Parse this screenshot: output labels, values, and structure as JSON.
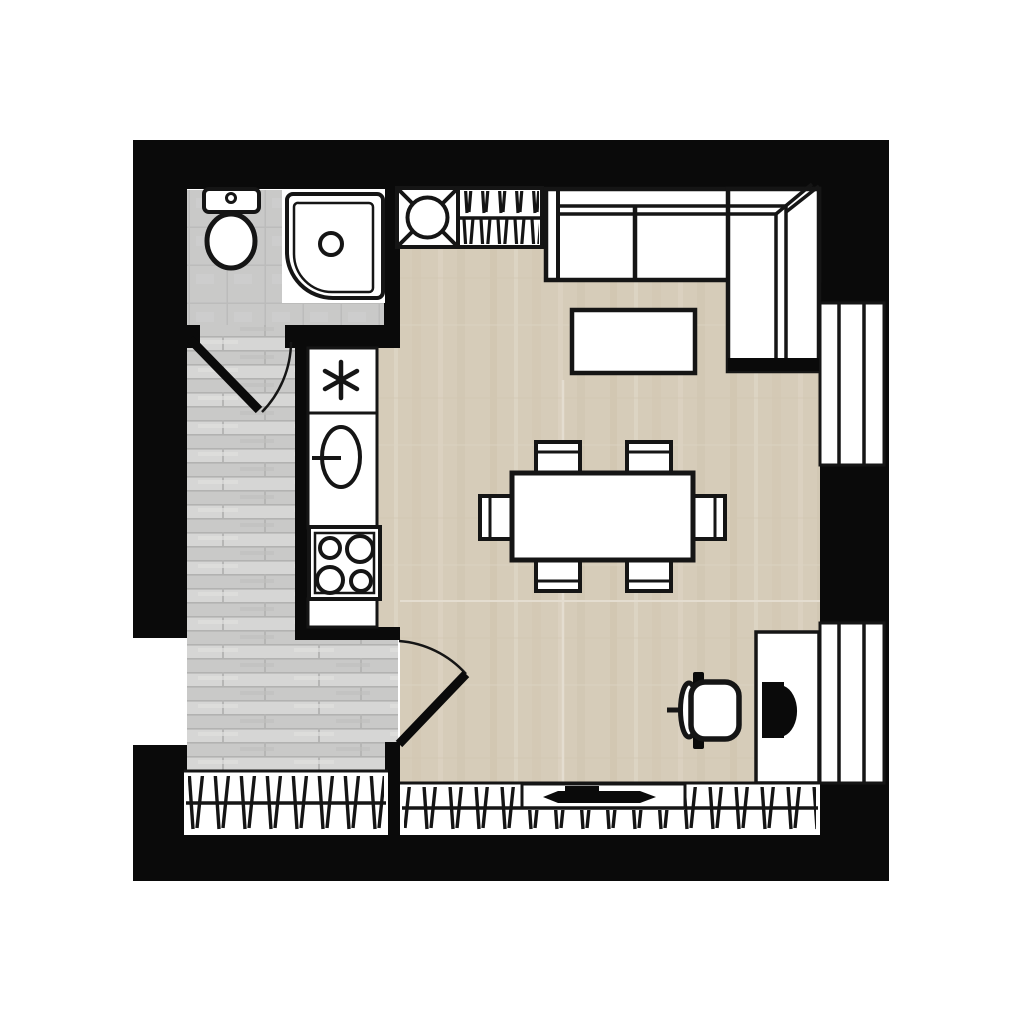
{
  "plan": {
    "type": "apartment-floor-plan",
    "colors": {
      "wall": "#0a0a0a",
      "outline": "#151515",
      "background": "#ffffff",
      "living_floor": "#d6ccb9",
      "living_floor_streak": "#cdc2ac",
      "living_floor_light": "#e0d8c9",
      "hall_floor": "#d6d6d5",
      "hall_floor_dark": "#c3c3c2",
      "hall_floor_line": "#b2b2b1",
      "bath_floor": "#c9c9c8",
      "bath_floor_line": "#bcbcbb",
      "fixture_fill": "#ffffff"
    },
    "rooms": [
      {
        "name": "bathroom",
        "fixtures": [
          "toilet",
          "shower-tray"
        ]
      },
      {
        "name": "hallway",
        "fixtures": [
          "bathroom-door-swing",
          "living-door-swing"
        ]
      },
      {
        "name": "living-kitchen",
        "fixtures": [
          "washing-machine",
          "wardrobe-rack",
          "corner-sofa",
          "coffee-table",
          "dining-table",
          "dining-chairs-x6",
          "fridge-unit-asterisk",
          "kitchen-sink",
          "cooktop-4-burner",
          "desk",
          "monitor",
          "office-chair"
        ]
      }
    ],
    "openings": [
      "window-right-upper",
      "window-right-lower",
      "window-left-hall",
      "window-band-bottom-left",
      "window-band-bottom-right",
      "balcony-door-handle",
      "bathroom-door",
      "living-room-door"
    ]
  }
}
